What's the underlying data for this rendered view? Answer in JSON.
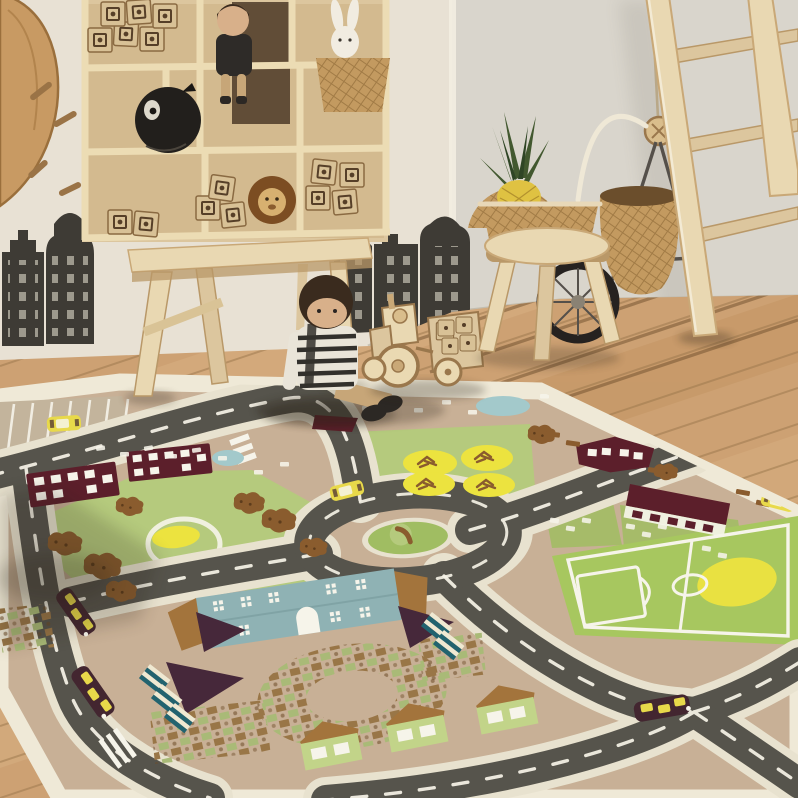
{
  "scene": {
    "type": "photograph",
    "setting": "children's playroom with a city road-map play rug on a wooden floor",
    "objects": [
      "decorative-branch",
      "wall-stick-decals",
      "canal-house-wall-decals-left",
      "canal-house-wall-decals-center",
      "wall-shelf",
      "toy-blocks",
      "black-ball-bank",
      "shelf-doll",
      "plush-bunny-in-basket",
      "lion-figurine",
      "wooden-bench",
      "rag-doll",
      "wooden-toy-tractor-with-trailer",
      "wooden-stool",
      "wicker-basket",
      "pineapple",
      "hanging-wicker-bag",
      "toy-wheel",
      "wooden-ladder",
      "wood-plank-floor",
      "city-road-play-rug",
      "rug-parking-lot",
      "rug-roundabout",
      "rug-soccer-field",
      "rug-red-roof-houses",
      "rug-blue-roof-building",
      "rug-garden-allotments",
      "rug-green-houses",
      "rug-toy-cars",
      "rug-yellow-trees",
      "rug-crosswalk"
    ]
  },
  "palette": {
    "wall": "#e8e1d4",
    "wallR": "#d9d5cc",
    "trim": "#f3eee2",
    "wallshade": "#c9c3b5",
    "floor": "#cda173",
    "floorLight": "#e0bd8f",
    "floorDark": "#b98a55",
    "woodLine": "#9a774c",
    "gapDark": "#6f4e2c",
    "rugBase": "#c8b096",
    "rugBorder": "#efe9d7",
    "rugEdge": "#403a30",
    "road": "#56544c",
    "roadLine": "#f7f4e8",
    "sidewalk": "#e8e2cf",
    "white": "#f6f4ea",
    "lawn": "#b5ca7d",
    "lawnDark": "#a0bd62",
    "field": "#a7c75f",
    "yellow": "#ece33f",
    "pondBlue": "#a3c9cb",
    "roofRed": "#5c1f2b",
    "roofBrown": "#a3743c",
    "houseGreen": "#c2d489",
    "bigRoof": "#8fb2b4",
    "purple": "#46283a",
    "bedTeal": "#22636f",
    "bedCream": "#efe9d2",
    "plotG": "#a9ba77",
    "plotB": "#997647",
    "bush": "#8a5c2e",
    "carBody": "#432630",
    "carYellow": "#e8d94a",
    "wood": "#e9d8b2",
    "woodMid": "#dcc69e",
    "woodShadow": "#b99868",
    "shelf": "#dcc69e",
    "shelfLight": "#ecdcb4",
    "shelfShade": "#c9ad7f",
    "openingDark": "#4c3a28",
    "block": "#d8c196",
    "blockInk": "#563f28",
    "decal": "#3e3b35",
    "decalLight": "#b5b0a2",
    "black": "#221f1c",
    "bunny": "#f1ece1",
    "lionMane": "#7c4d22",
    "lionFace": "#d7b070",
    "hair": "#3a2b1e",
    "skin": "#d8b08a",
    "pants": "#c7a678",
    "stripeDark": "#32302c",
    "stripeLight": "#e9e4d8",
    "wicker": "#c39a60",
    "wickerDark": "#8f6a38",
    "pineBody": "#dfc242",
    "pineLeaf": "#42582f",
    "metal": "#55504a"
  }
}
